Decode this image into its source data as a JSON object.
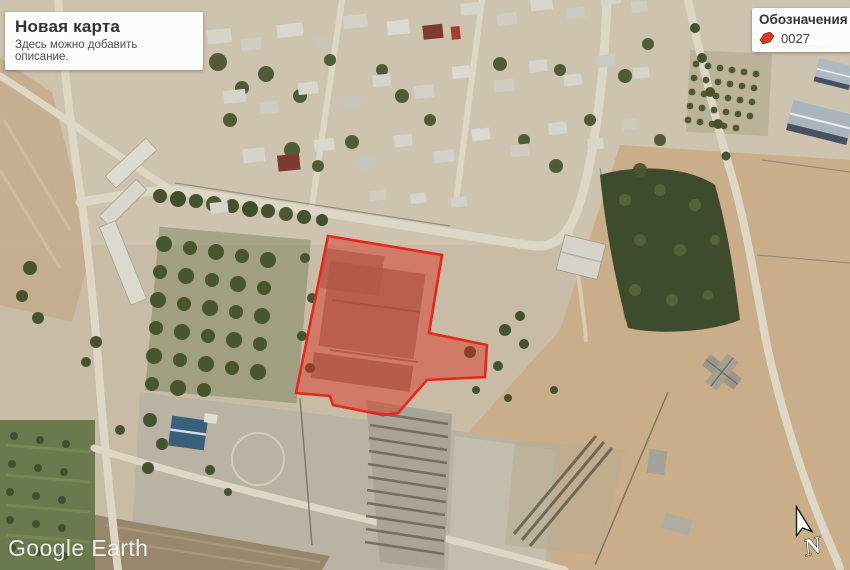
{
  "map_overlay": {
    "title_panel": {
      "title": "Новая карта",
      "description": "Здесь можно добавить описание."
    },
    "legend_panel": {
      "title": "Обозначения",
      "items": [
        {
          "label": "0027",
          "icon": "red-polygon-icon",
          "icon_color": "#d63a26"
        }
      ]
    },
    "watermark": "Google Earth",
    "north_label": "N",
    "highlight_polygon": {
      "id": "0027",
      "points": "328,236 442,255 429,333 487,345 485,377 427,380 398,413 383,415 333,405 330,396 296,393",
      "stroke": "#e8271a",
      "fill": "#dd2c1c",
      "fill_opacity": 0.46
    }
  }
}
